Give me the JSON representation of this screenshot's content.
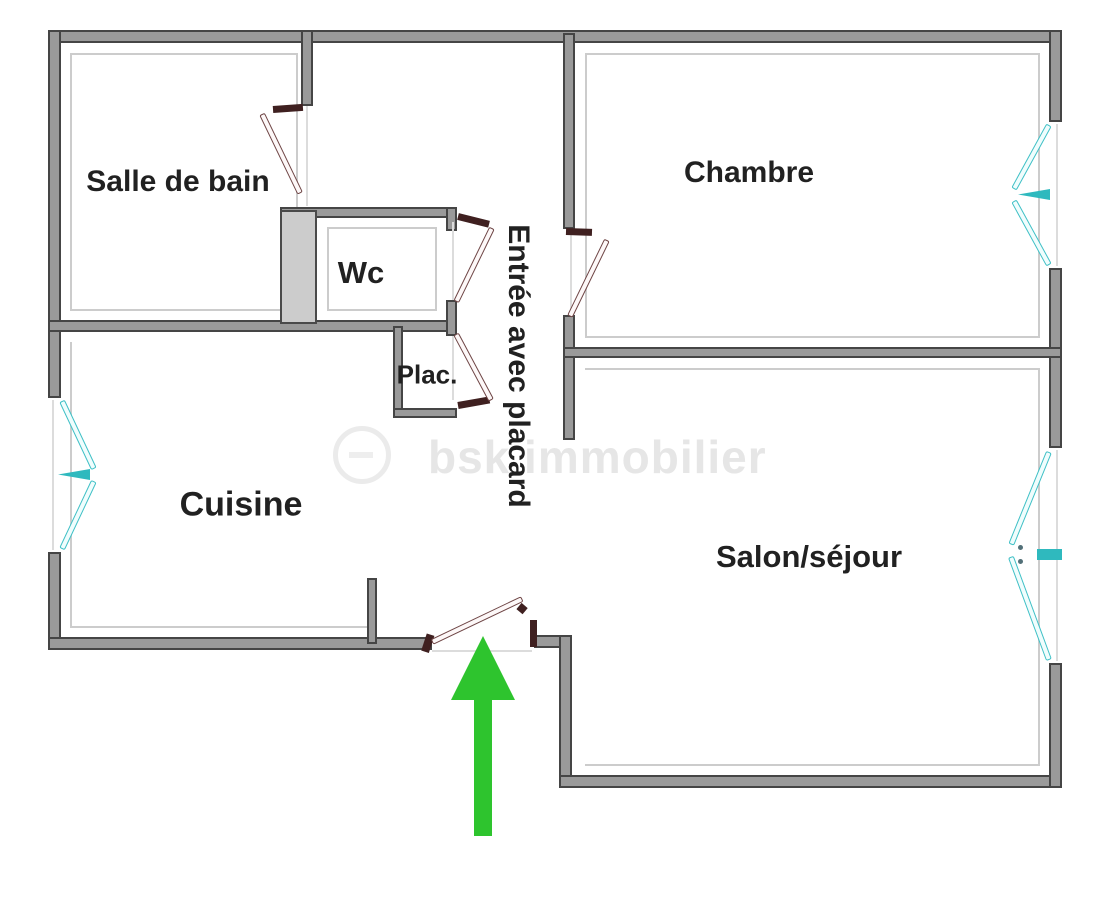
{
  "plan": {
    "rooms": {
      "bathroom": "Salle de bain",
      "wc": "Wc",
      "closet": "Plac.",
      "entry": "Entrée avec placard",
      "bedroom": "Chambre",
      "kitchen": "Cuisine",
      "living_room": "Salon/séjour"
    },
    "watermark": {
      "text": "bsk immobilier",
      "logo_icon": "circle-logo"
    },
    "entrance_arrow_icon": "green-arrow-up",
    "colors": {
      "wall_fill": "#9a9a9a",
      "wall_edge": "#454545",
      "shaded_wall": "#cccccc",
      "door_swing": "#6e4545",
      "door_hinge": "#3f2020",
      "window_symbol": "#3fc0c6",
      "window_tick": "#2fb9be",
      "entrance_arrow": "#2ec42e",
      "label_text": "#212121",
      "watermark": "#e6e6e6",
      "background": "#ffffff"
    }
  }
}
